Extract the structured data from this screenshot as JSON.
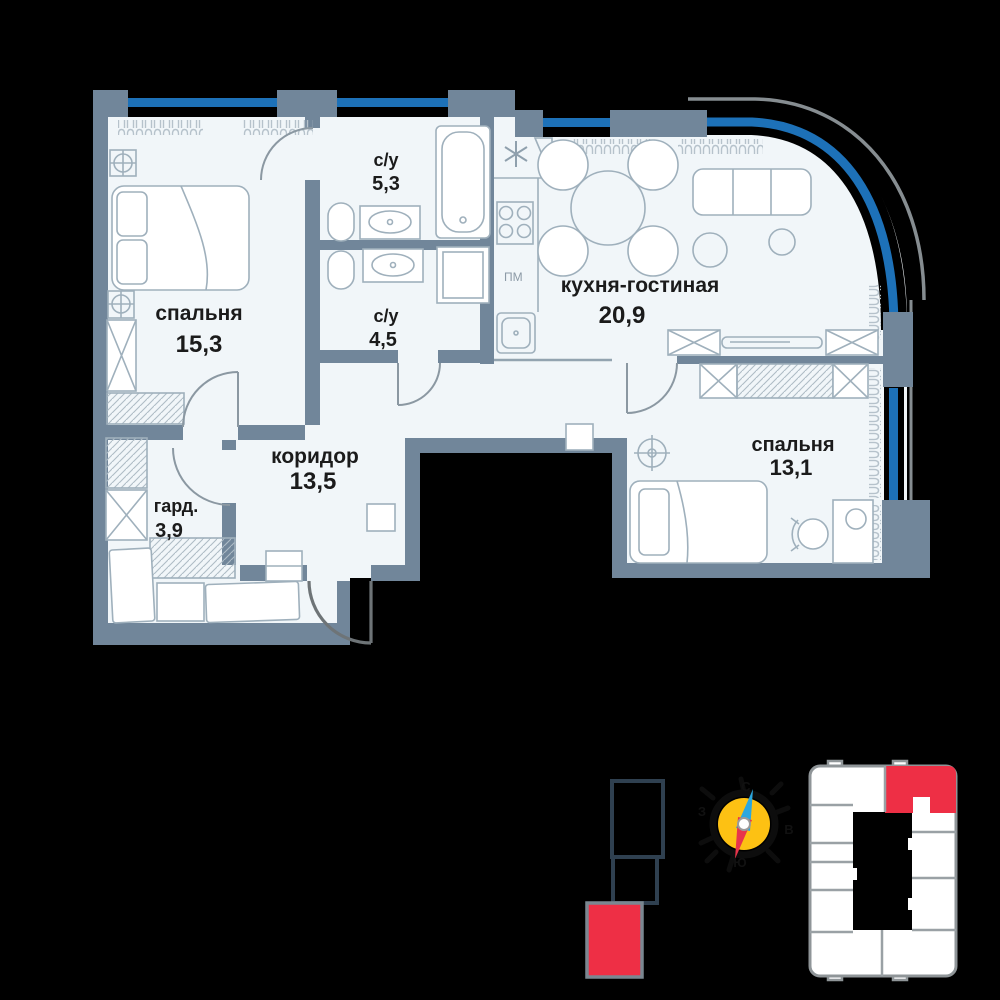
{
  "plan": {
    "rooms": [
      {
        "key": "bedroom-1",
        "name": "спальня",
        "area": "15,3"
      },
      {
        "key": "bathroom-1",
        "name": "с/у",
        "area": "5,3"
      },
      {
        "key": "bathroom-2",
        "name": "с/у",
        "area": "4,5"
      },
      {
        "key": "kitchen-living",
        "name": "кухня-гостиная",
        "area": "20,9"
      },
      {
        "key": "corridor",
        "name": "коридор",
        "area": "13,5"
      },
      {
        "key": "wardrobe",
        "name": "гард.",
        "area": "3,9"
      },
      {
        "key": "bedroom-2",
        "name": "спальня",
        "area": "13,1"
      }
    ],
    "appliances": {
      "dishwasher_label": "ПМ"
    }
  },
  "compass": {
    "north": "С",
    "east": "В",
    "south": "Ю",
    "west": "З"
  },
  "colors": {
    "background": "#000000",
    "floor": "#f1f6f9",
    "walls": "#71869a",
    "window_glazing": "#1d71b8",
    "furniture_outline": "#9fb0bc",
    "highlight_red": "#ee2f45",
    "compass_yellow": "#fdc113",
    "compass_needle_blue": "#2ba7df",
    "compass_needle_red": "#e8344b",
    "text": "#1b1b1b"
  }
}
